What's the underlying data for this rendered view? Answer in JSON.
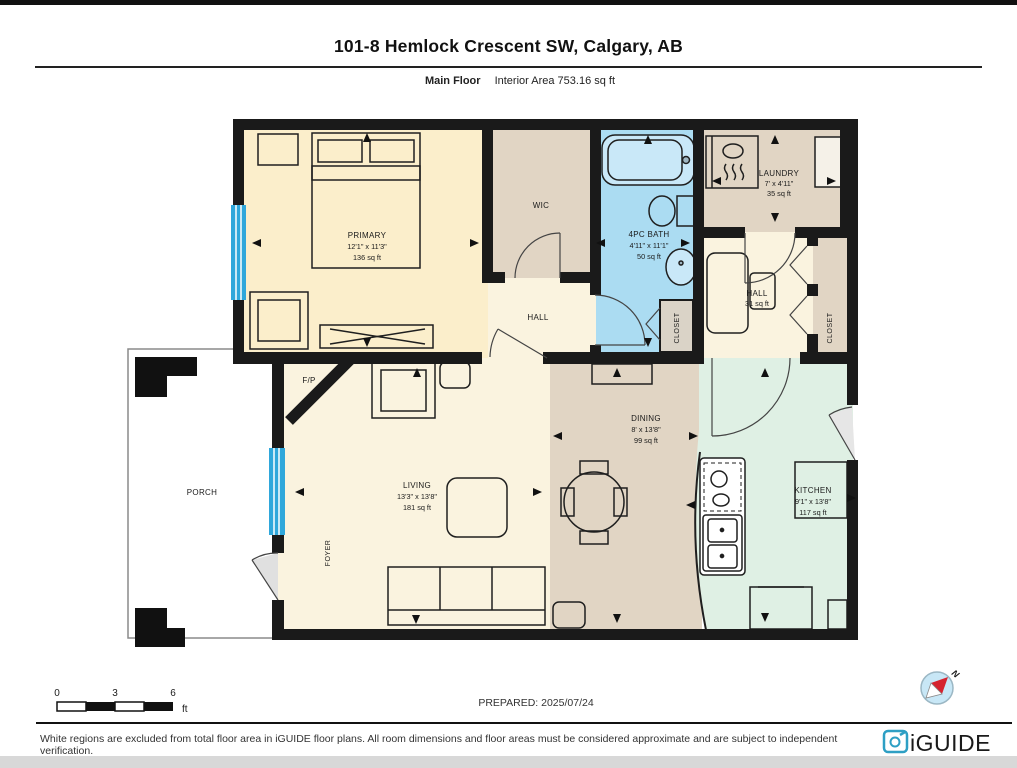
{
  "header": {
    "title": "101-8 Hemlock Crescent SW, Calgary, AB",
    "floor_label": "Main Floor",
    "area_label": "Interior Area 753.16 sq ft"
  },
  "rooms": {
    "primary": {
      "name": "PRIMARY",
      "dims": "12'1\" x 11'3\"",
      "area": "136 sq ft"
    },
    "bath": {
      "name": "4PC BATH",
      "dims": "4'11\" x 11'1\"",
      "area": "50 sq ft"
    },
    "laundry": {
      "name": "LAUNDRY",
      "dims": "7' x 4'11\"",
      "area": "35 sq ft"
    },
    "hall_lower": {
      "name": "HALL",
      "area": "31 sq ft"
    },
    "living": {
      "name": "LIVING",
      "dims": "13'3\" x 13'8\"",
      "area": "181 sq ft"
    },
    "dining": {
      "name": "DINING",
      "dims": "8' x 13'8\"",
      "area": "99 sq ft"
    },
    "kitchen": {
      "name": "KITCHEN",
      "dims": "9'1\" x 13'8\"",
      "area": "117 sq ft"
    }
  },
  "labels": {
    "wic": "WIC",
    "hall_upper": "HALL",
    "closet": "CLOSET",
    "fp": "F/P",
    "foyer": "FOYER",
    "porch": "PORCH"
  },
  "scale_bar": {
    "tick0": "0",
    "tick3": "3",
    "tick6": "6",
    "unit": "ft"
  },
  "prepared_label": "PREPARED: 2025/07/24",
  "compass": {
    "north_label": "N"
  },
  "footer": {
    "disclaimer": "White regions are excluded from total floor area in iGUIDE floor plans. All room dimensions and floor areas must be considered approximate and are subject to independent verification.",
    "logo_text": "iGUIDE"
  },
  "colors": {
    "wall": "#1a1a1a",
    "cream_primary": "#FBEECB",
    "cream_living": "#FAF3DF",
    "tan": "#E1D5C4",
    "closet_gray": "#DAD3C7",
    "bath_blue": "#ABDCF2",
    "tub_blue": "#C9E8F8",
    "kitchen_mint": "#DFF0E4",
    "window_blue": "#2FA7DB",
    "logo_teal": "#2E9FC4"
  }
}
